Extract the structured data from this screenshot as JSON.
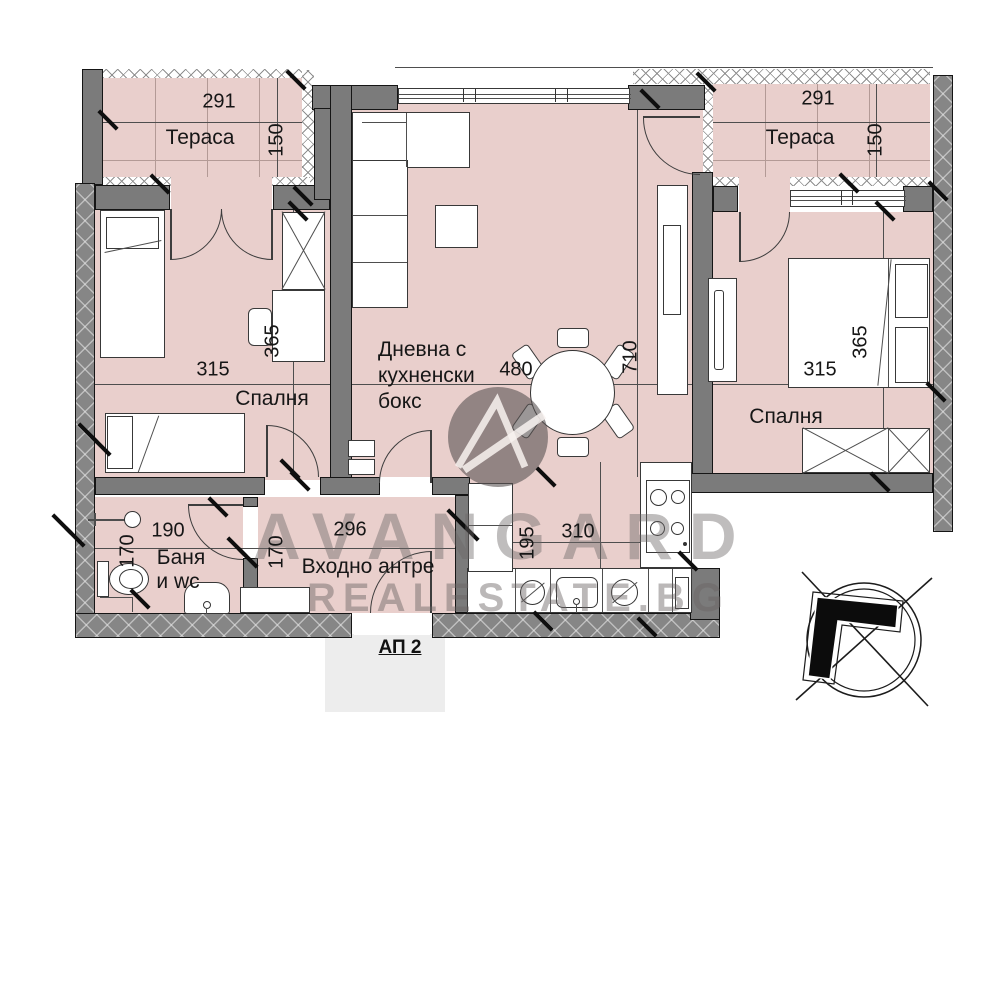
{
  "plan": {
    "apartment_label": "АП 2",
    "watermark": {
      "brand": "AVANGARD",
      "site": "REALESTATE.BG"
    },
    "rooms": {
      "terrace_left": {
        "name": "Тераса",
        "dim_w": "291",
        "dim_h": "150"
      },
      "terrace_right": {
        "name": "Тераса",
        "dim_w": "291",
        "dim_h": "150"
      },
      "bedroom_left": {
        "name": "Спалня",
        "dim_w": "315",
        "dim_h": "365"
      },
      "bedroom_right": {
        "name": "Спалня",
        "dim_w": "315",
        "dim_h": "365"
      },
      "living": {
        "name_l1": "Дневна с",
        "name_l2": "кухненски",
        "name_l3": "бокс",
        "dim_w": "480",
        "dim_h": "710"
      },
      "bathroom": {
        "name_l1": "Баня",
        "name_l2": "и wc",
        "dim_w": "190",
        "dim_h": "170"
      },
      "hall": {
        "name": "Входно антре",
        "dim_w": "296",
        "dim_h": "170"
      },
      "kitchen": {
        "dim_w": "310",
        "dim_h": "195"
      }
    },
    "colors": {
      "floor": "#e9cfcc",
      "wall": "#7b7b7b",
      "watermark": "#6a6565"
    }
  }
}
